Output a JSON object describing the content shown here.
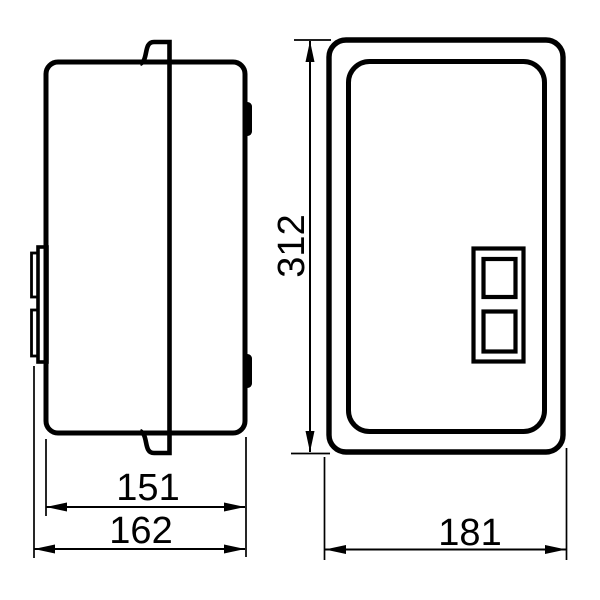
{
  "drawing": {
    "background_color": "#ffffff",
    "line_color": "#000000",
    "views": {
      "side_view": {
        "dimensions": {
          "body_depth": "151",
          "overall_depth": "162"
        }
      },
      "front_view": {
        "dimensions": {
          "height": "312",
          "width": "181"
        }
      }
    }
  }
}
